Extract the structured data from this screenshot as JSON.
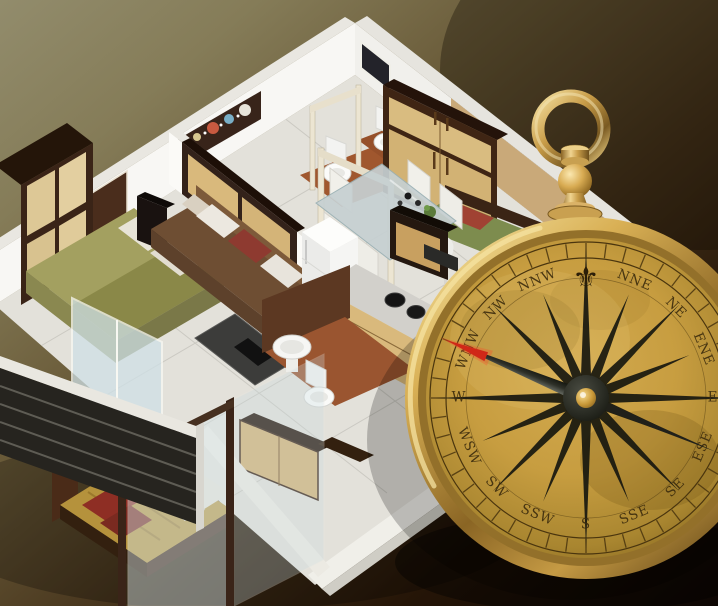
{
  "image_type": "photo-composite",
  "title": "3D isometric apartment floor plan with brass direction compass",
  "background": {
    "top_left": "#928c6c",
    "mid": "#5a4a2e",
    "bottom_right": "#0d0603"
  },
  "floor_plan": {
    "style": "isometric 3D render",
    "wall_color": "#f6f5f2",
    "floor_color": "#e3e1da",
    "wood_dark": "#3f2514",
    "wood_light": "#d9b97c",
    "rooms": [
      {
        "name": "master-bedroom",
        "furniture": [
          "wardrobe",
          "double-bed",
          "sideboard"
        ],
        "bed_color": "#a3a060"
      },
      {
        "name": "living-room",
        "furniture": [
          "sofa",
          "coffee-table",
          "tv-unit",
          "floor-lamp"
        ],
        "sofa_color": "#6e4e33",
        "pillow_colors": [
          "#ece8e0",
          "#8e3a30"
        ]
      },
      {
        "name": "dining-area",
        "furniture": [
          "glass-dining-table",
          "chairs"
        ],
        "chair_count": 5
      },
      {
        "name": "kitchen",
        "furniture": [
          "refrigerator",
          "gas-stove-counter",
          "cabinets"
        ],
        "cabinet_color": "#d9b97c"
      },
      {
        "name": "bathroom-1",
        "furniture": [
          "toilet"
        ],
        "floor_color": "#a0572e"
      },
      {
        "name": "bathroom-2",
        "furniture": [
          "toilet"
        ],
        "floor_color": "#96502a"
      },
      {
        "name": "bathroom-3",
        "furniture": [
          "wash-basin",
          "toilet"
        ],
        "floor_color": "#9a5530"
      },
      {
        "name": "bedroom-right",
        "furniture": [
          "bed",
          "tall-wardrobe",
          "side-table"
        ],
        "bed_color": "#7d8c4e"
      },
      {
        "name": "bedroom-bottom",
        "furniture": [
          "double-bed",
          "glass-partition",
          "cabinet"
        ],
        "bed_color": "#b5923c",
        "pillow_color": "#8e2e24"
      },
      {
        "name": "balcony",
        "furniture": [
          "dark-railing",
          "sliding-glass-door"
        ]
      }
    ],
    "wall_art": {
      "type": "flower-panel",
      "colors": [
        "#e8e4da",
        "#79aec6",
        "#c85a40",
        "#d8c890"
      ]
    }
  },
  "compass": {
    "type": "brass pocket compass",
    "north_marker": "⚜",
    "directions": [
      "NNE",
      "NE",
      "ENE",
      "E",
      "ESE",
      "SE",
      "SSE",
      "S",
      "SSW",
      "SW",
      "WSW",
      "W",
      "WNW",
      "NW",
      "NNW"
    ],
    "needle_heading": "WNW",
    "needle_tip_color": "#d02818",
    "dial_color": "#c79d40",
    "bezel_color": "#d9b055",
    "label_color": "#3b2b0d",
    "tick_count": 48,
    "rose_points": 16
  }
}
